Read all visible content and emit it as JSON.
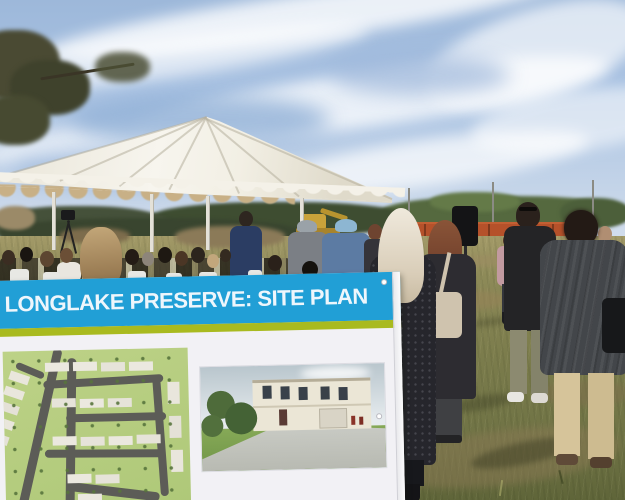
{
  "sign": {
    "title": "LONGLAKE PRESERVE: SITE PLAN"
  },
  "colors": {
    "sign_blue": "#219fd6",
    "sign_stripe": "#a9ba1f",
    "sign_panel": "#f2f1f5",
    "sign_title_text": "#eef6fc",
    "sky_top": "#9db8da",
    "sky_bottom": "#d8e1ee",
    "tent_canvas": "#f2efe4",
    "tent_valance_tan": "#c8b086",
    "treeline_green": "#4c5f3a",
    "train_orange": "#b5512a",
    "grass_olive": "#7b7c4c",
    "grass_far": "#a39a68",
    "excavator_yellow": "#c9a23a"
  }
}
